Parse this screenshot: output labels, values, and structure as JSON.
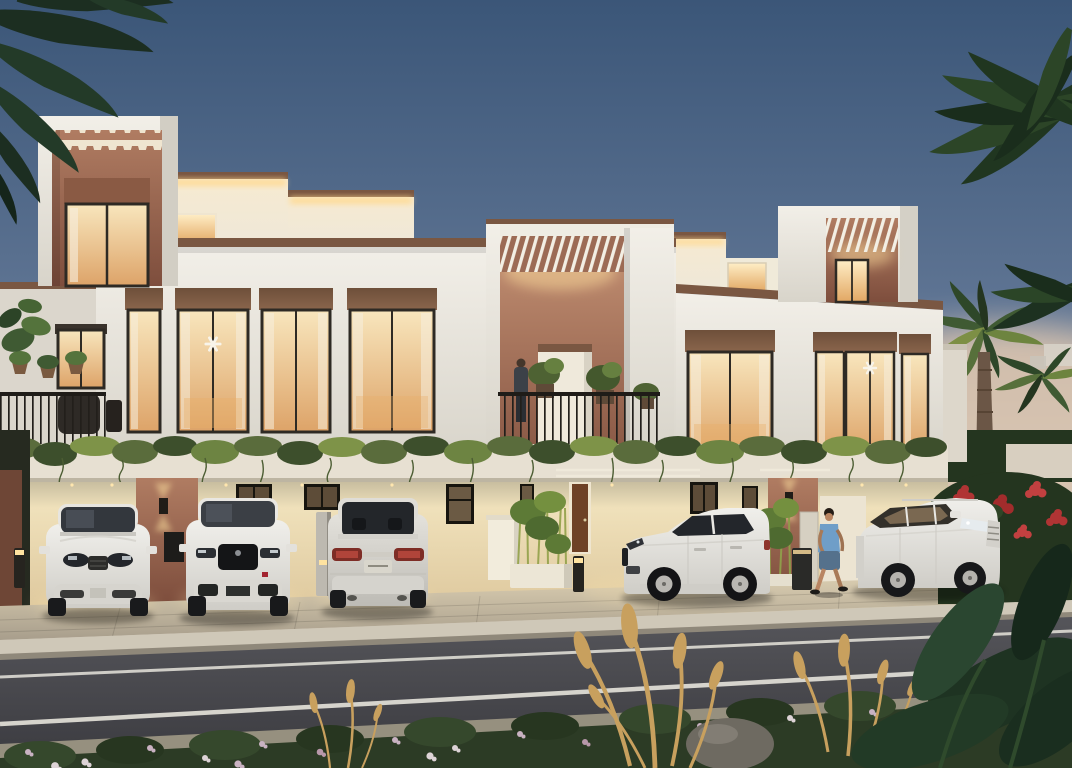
{
  "scene": {
    "title": "Modern townhouse row at dusk - architectural rendering",
    "time_of_day": "dusk",
    "building": {
      "storeys": 2,
      "style": "white render with terracotta accent panels",
      "features": [
        "rooftop pergola boxes with warm LED cove lighting",
        "crenellated terracotta feature panel on left tower",
        "central balcony with railing, plants and resident",
        "vine-draped podium ledge between floors",
        "ground-floor carports with downlights",
        "bamboo planters",
        "up/down wall sconces on terracotta piers"
      ]
    },
    "vehicles": [
      {
        "id": "suv-front-left",
        "color": "white",
        "view": "front"
      },
      {
        "id": "suv-front-black-grille",
        "color": "white",
        "view": "front"
      },
      {
        "id": "suv-rear",
        "color": "white",
        "view": "rear"
      },
      {
        "id": "compact-suv-side",
        "color": "white",
        "view": "side"
      },
      {
        "id": "suv-three-quarter-right",
        "color": "white",
        "view": "three-quarter front"
      }
    ],
    "people": [
      {
        "id": "balcony-resident",
        "location": "central balcony"
      },
      {
        "id": "walking-man",
        "location": "driveway",
        "clothing": "blue t-shirt and denim shorts"
      }
    ],
    "landscape": [
      "dark palm fronds overhanging top-left",
      "tall palm right edge",
      "small lit palms behind right wing",
      "red bougainvillea hedge right",
      "flowering hedge in road median",
      "golden fountain grass plumes",
      "large tropical leaves bottom-right",
      "grey boulder"
    ],
    "road": {
      "lane_lines": 2,
      "surface": "asphalt",
      "kerb": "light stone"
    }
  },
  "colors": {
    "sky_top": "#3b5678",
    "sky_mid": "#5d7392",
    "sky_low": "#93a2b4",
    "sky_horizon": "#cdc0b2",
    "sunset_glow": "#e8ccb0",
    "facade_light": "#f2efe8",
    "facade_shadow": "#d8d4ca",
    "coping_brown": "#7a5742",
    "terracotta_light": "#b07c62",
    "terracotta_dark": "#7e4e3d",
    "dentil_cream": "#efe5d0",
    "roofwall_lit": "#f7ead0",
    "led_glow": "#ffd98f",
    "glass_top": "#f8e6bd",
    "glass_bottom": "#dda368",
    "window_frame": "#2e2a24",
    "header_brown": "#8a654c",
    "curtain": "#f6efdf",
    "vine_green": "#5a6c3c",
    "vine_light": "#7e9348",
    "vine_dark": "#3d4f2c",
    "cream_light": "#f4e7c2",
    "cream_dark": "#ddc79c",
    "door_brown": "#6e4126",
    "bamboo_green": "#6d8a3f",
    "pave_light": "#dccfb2",
    "pave_dark": "#a89e8c",
    "curb_light": "#cfc8b8",
    "road_light": "#55555a",
    "road_dark": "#3c3c41",
    "lane_line": "#dedcd4",
    "median_gray": "#96907f",
    "hedge_green": "#2c3b25",
    "flower_pink": "#c9b2c2",
    "flower_white": "#ddd3d6",
    "bougainvillea_red": "#b03434",
    "grass_gold": "#c8a05e",
    "palm_dark": "#1c2e21",
    "palm_mid": "#2c4527",
    "palm_warm": "#7d8f45",
    "car_white": "#f0efeb",
    "car_shadow_tone": "#cfcdc7",
    "car_glass": "#33373d",
    "tail_red": "#b0443a",
    "skin_tone": "#b98562",
    "shirt_blue": "#6f9ec8",
    "denim_blue": "#55718c",
    "bollard_dark": "#26241f",
    "light_warm": "#ffe3a0",
    "rock_gray": "#6e6a61",
    "trunk_brown": "#6b5646",
    "distant_white": "#d7d2c8"
  }
}
